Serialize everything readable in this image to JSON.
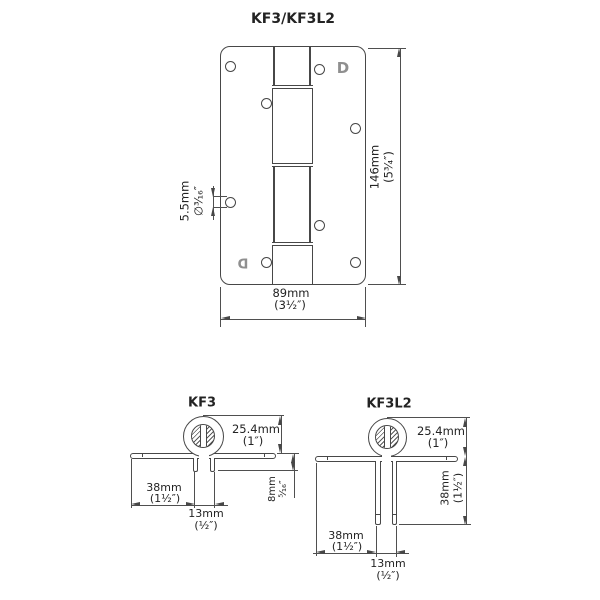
{
  "title": "KF3/KF3L2",
  "top_view": {
    "height_mm": "146mm",
    "height_in": "(5³⁄₄″)",
    "width_mm": "89mm",
    "width_in": "(3¹⁄₂″)",
    "hole_mm": "5.5mm",
    "hole_in": "∅³⁄₁₆″"
  },
  "kf3": {
    "title": "KF3",
    "pin_mm": "25.4mm",
    "pin_in": "(1″)",
    "flange_mm": "38mm",
    "flange_in": "(1¹⁄₂″)",
    "slot_mm": "13mm",
    "slot_in": "(¹⁄₂″)",
    "lip_mm": "8mm",
    "lip_in": "⁵⁄₁₆″"
  },
  "kf3l2": {
    "title": "KF3L2",
    "pin_mm": "25.4mm",
    "pin_in": "(1″)",
    "leg_mm": "38mm",
    "leg_in": "(1¹⁄₂″)",
    "flange_mm": "38mm",
    "flange_in": "(1¹⁄₂″)",
    "slot_mm": "13mm",
    "slot_in": "(¹⁄₂″)"
  },
  "logo_glyph": "D",
  "colors": {
    "line": "#474747",
    "text": "#232323",
    "logo": "#8f8f8f",
    "background": "#ffffff"
  }
}
